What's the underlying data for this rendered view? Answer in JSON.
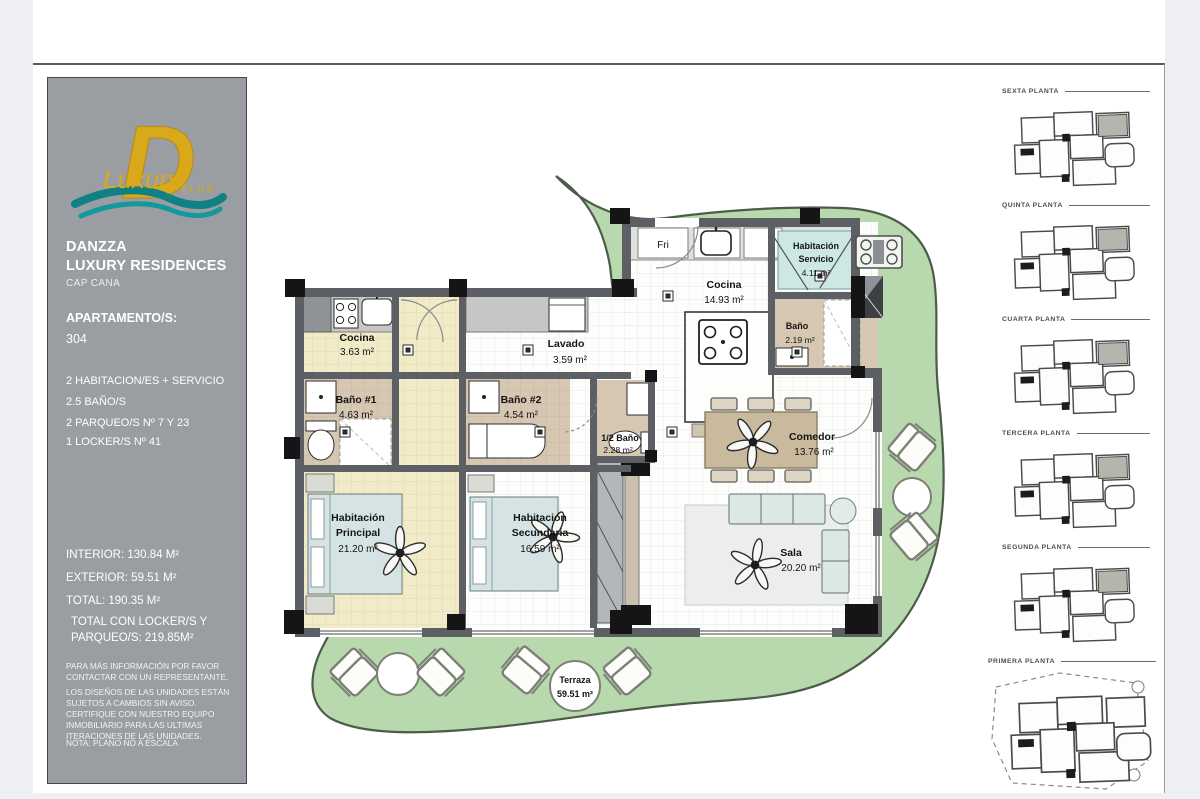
{
  "sidebar": {
    "brand_line1": "DANZZA",
    "brand_line2": "LUXURY RESIDENCES",
    "brand_sub": "CAP CANA",
    "apt_label": "APARTAMENTO/S:",
    "apt_number": "304",
    "features": [
      "2 HABITACION/ES + SERVICIO",
      "2.5 BAÑO/S",
      "2 PARQUEO/S Nº 7 Y 23"
    ],
    "locker": "1 LOCKER/S Nº 41",
    "areas": [
      "INTERIOR: 130.84 M²",
      "EXTERIOR: 59.51 M²",
      "TOTAL: 190.35 M²"
    ],
    "total_line1": "TOTAL CON LOCKER/S Y",
    "total_line2": "PARQUEO/S:  219.85M²",
    "disclaimer1": "PARA MÁS INFORMACIÓN POR FAVOR CONTACTAR CON UN REPRESENTANTE.",
    "disclaimer2": "LOS DISEÑOS DE LAS UNIDADES ESTÁN SUJETOS A CAMBIOS SIN AVISO. CERTIFIQUE CON NUESTRO EQUIPO INMOBILIARIO PARA LAS ULTIMAS ITERACIONES DE LAS UNIDADES.",
    "note": "NOTA: PLANO NO A ESCALA",
    "logo": {
      "letter": "D",
      "script": "Luxury",
      "plus": "PLUS"
    }
  },
  "colors": {
    "sidebar_gray": "#9a9da2",
    "terrace_green": "#b7d9ad",
    "floor_yellow": "#f2ebc8",
    "floor_beige": "#d6c7b2",
    "bed_teal": "#cde7e3",
    "wall_gray": "#5c5f63",
    "logo_gold": "#d9a91c",
    "logo_teal": "#0d8184"
  },
  "plan": {
    "fri_label": "Fri",
    "rooms": [
      {
        "l1": "Cocina",
        "l2": "3.63 m²"
      },
      {
        "l1": "Lavado",
        "l2": "3.59 m²"
      },
      {
        "l1": "Baño #1",
        "l2": "4.63 m²"
      },
      {
        "l1": "Baño #2",
        "l2": "4.54 m²"
      },
      {
        "l1": "1/2 Baño",
        "l2": "2.28 m²"
      },
      {
        "l1": "Habitación",
        "l2": "Principal",
        "l3": "21.20 m²"
      },
      {
        "l1": "Habitación",
        "l2": "Secundaria",
        "l3": "16.59 m²"
      },
      {
        "l1": "Cocina",
        "l2": "14.93 m²"
      },
      {
        "l1": "Habitación",
        "l2": "Servicio",
        "l3": "4.11 m²"
      },
      {
        "l1": "Baño",
        "l2": "2.19 m²"
      },
      {
        "l1": "Comedor",
        "l2": "13.76 m²"
      },
      {
        "l1": "Sala",
        "l2": "20.20 m²"
      },
      {
        "l1": "Terraza",
        "l2": "59.51 m²"
      }
    ]
  },
  "floors": [
    {
      "label": "SEXTA PLANTA"
    },
    {
      "label": "QUINTA PLANTA"
    },
    {
      "label": "CUARTA PLANTA"
    },
    {
      "label": "TERCERA PLANTA"
    },
    {
      "label": "SEGUNDA PLANTA"
    },
    {
      "label": "PRIMERA PLANTA"
    }
  ]
}
